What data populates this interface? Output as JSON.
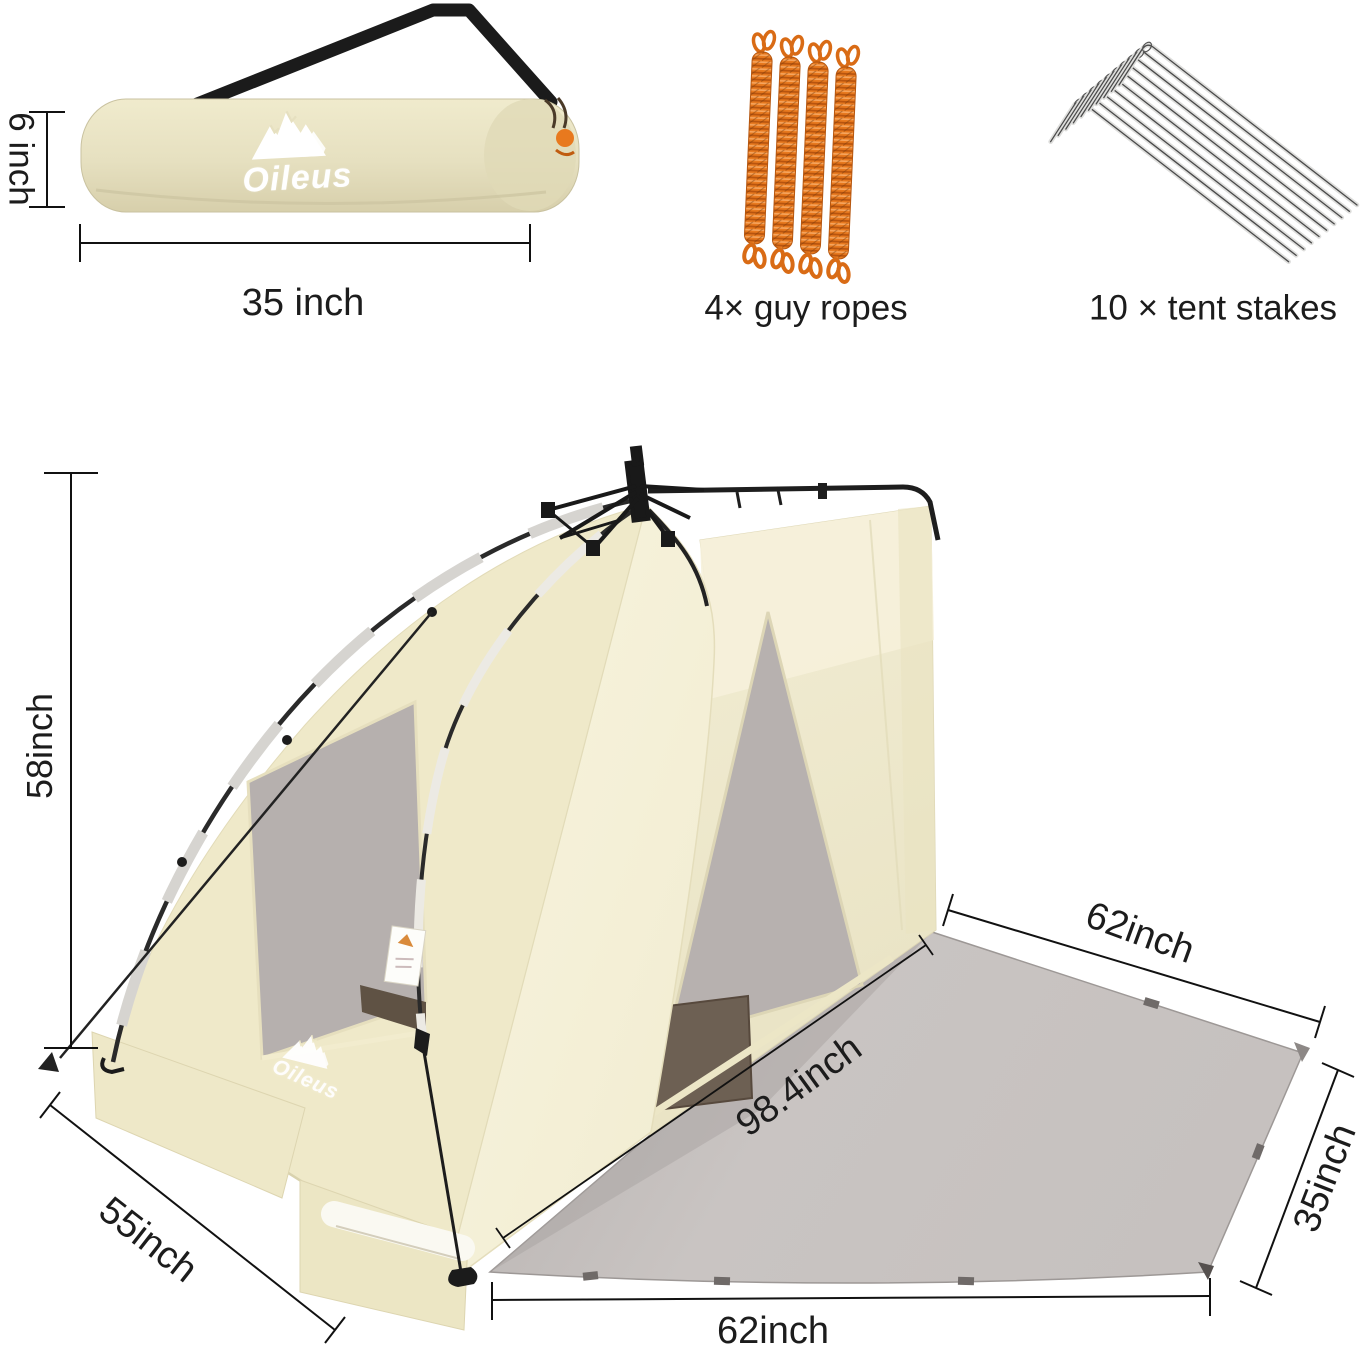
{
  "brand": {
    "name": "Oileus"
  },
  "packed_bag": {
    "height_label": "6 inch",
    "length_label": "35 inch"
  },
  "accessories": {
    "guy_ropes": {
      "label": "4× guy ropes",
      "count": 4,
      "color": "#E8791E"
    },
    "tent_stakes": {
      "label": "10 × tent stakes",
      "count": 10
    }
  },
  "tent": {
    "height_label": "58inch",
    "side_width_label": "55inch",
    "mat_top_edge_label": "62inch",
    "mat_diagonal_label": "98.4inch",
    "mat_side_edge_label": "35inch",
    "mat_bottom_edge_label": "62inch",
    "fabric_color": "#F2EDD3",
    "mat_color": "#C8C3C1",
    "frame_color": "#1E1E1E"
  }
}
